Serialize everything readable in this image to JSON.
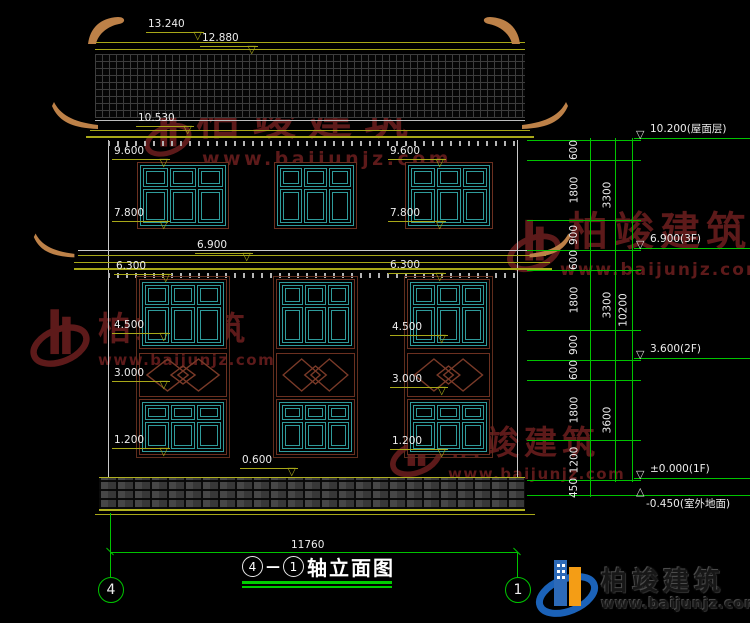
{
  "drawing": {
    "title": {
      "axis_a": "4",
      "dash": "—",
      "axis_b": "1",
      "name": "轴立面图"
    },
    "axis_bubbles": {
      "left": "4",
      "right": "1"
    },
    "bottom_dim": "11760",
    "top_marks": [
      {
        "label": "13.240",
        "x": 146,
        "y": 19
      },
      {
        "label": "12.880",
        "x": 200,
        "y": 33
      },
      {
        "label": "10.530",
        "x": 136,
        "y": 113
      }
    ],
    "left_marks": [
      {
        "label": "9.600",
        "x": 112,
        "y": 146
      },
      {
        "label": "7.800",
        "x": 112,
        "y": 208
      },
      {
        "label": "6.300",
        "x": 114,
        "y": 261
      },
      {
        "label": "4.500",
        "x": 112,
        "y": 320
      },
      {
        "label": "3.000",
        "x": 112,
        "y": 368
      },
      {
        "label": "1.200",
        "x": 112,
        "y": 435
      }
    ],
    "mid_marks": [
      {
        "label": "9.600",
        "x": 388,
        "y": 146
      },
      {
        "label": "7.800",
        "x": 388,
        "y": 208
      },
      {
        "label": "6.300",
        "x": 388,
        "y": 260
      },
      {
        "label": "4.500",
        "x": 390,
        "y": 322
      },
      {
        "label": "3.000",
        "x": 390,
        "y": 374
      },
      {
        "label": "1.200",
        "x": 390,
        "y": 436
      }
    ],
    "center_marks": [
      {
        "label": "6.900",
        "x": 195,
        "y": 240
      },
      {
        "label": "0.600",
        "x": 240,
        "y": 455
      }
    ],
    "right_levels": [
      {
        "label": "10.200(屋面层)",
        "y": 124
      },
      {
        "label": "6.900(3F)",
        "y": 234
      },
      {
        "label": "3.600(2F)",
        "y": 344
      },
      {
        "label": "±0.000(1F)",
        "y": 464
      }
    ],
    "ground_level": {
      "label": "-0.450(室外地面)"
    },
    "chain_inner": [
      {
        "label": "600",
        "y1": 140,
        "y2": 160
      },
      {
        "label": "1800",
        "y1": 160,
        "y2": 220
      },
      {
        "label": "900",
        "y1": 220,
        "y2": 250
      },
      {
        "label": "600",
        "y1": 250,
        "y2": 270
      },
      {
        "label": "1800",
        "y1": 270,
        "y2": 330
      },
      {
        "label": "900",
        "y1": 330,
        "y2": 360
      },
      {
        "label": "600",
        "y1": 360,
        "y2": 380
      },
      {
        "label": "1800",
        "y1": 380,
        "y2": 440
      },
      {
        "label": "1200",
        "y1": 440,
        "y2": 480
      },
      {
        "label": "450",
        "y1": 480,
        "y2": 495
      }
    ],
    "chain_mid": [
      {
        "label": "3300",
        "y1": 140,
        "y2": 250
      },
      {
        "label": "3300",
        "y1": 250,
        "y2": 360
      },
      {
        "label": "3600",
        "y1": 360,
        "y2": 480
      }
    ],
    "chain_outer": [
      {
        "label": "10200",
        "y1": 140,
        "y2": 480
      }
    ],
    "ext_lines": [
      140,
      160,
      220,
      250,
      270,
      330,
      360,
      380,
      440,
      480,
      495
    ]
  },
  "watermark": {
    "name": "柏竣建筑",
    "url": "www.baijunjz.com"
  },
  "logo": {
    "name": "柏竣建筑",
    "url": "www.baijunjz.com"
  }
}
